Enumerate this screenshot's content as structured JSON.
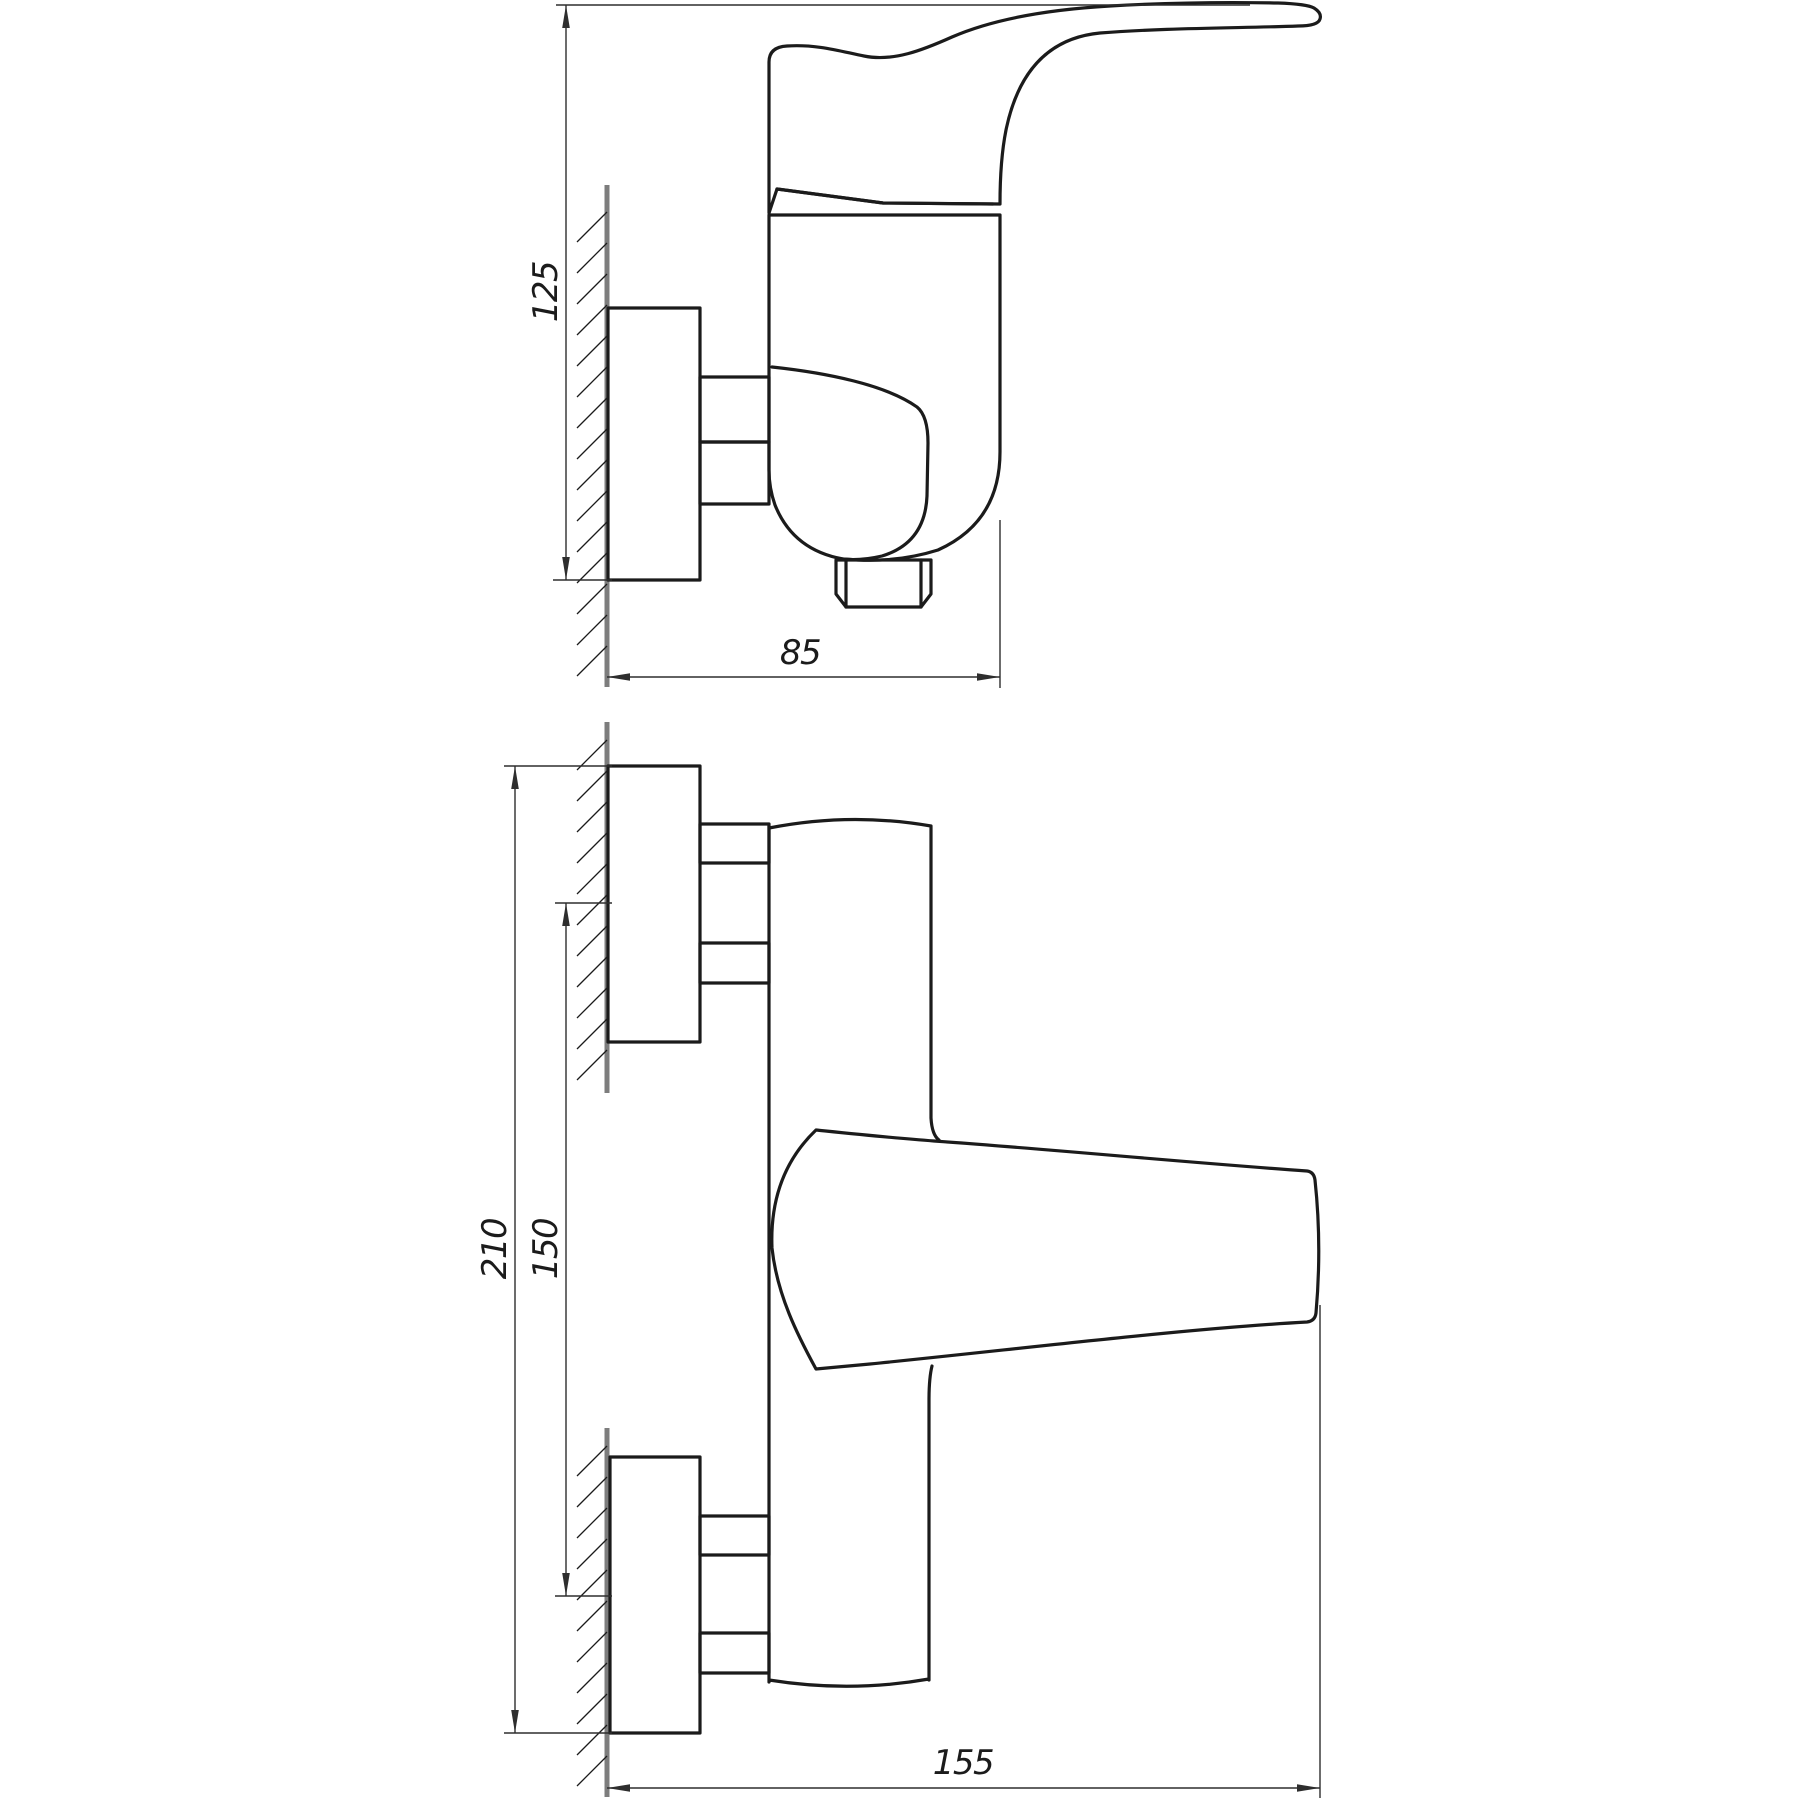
{
  "drawing": {
    "views": {
      "side": {
        "dim_height": {
          "value": "125"
        },
        "dim_depth": {
          "value": "85"
        }
      },
      "front": {
        "dim_overall_height": {
          "value": "210"
        },
        "dim_inlet_spacing": {
          "value": "150"
        },
        "dim_width": {
          "value": "155"
        }
      }
    },
    "colors": {
      "outline": "#1b1b1b",
      "dimension": "#2e2e2e",
      "wall": "#7d7d7d",
      "text": "#1b1b1b",
      "background": "#ffffff"
    }
  }
}
